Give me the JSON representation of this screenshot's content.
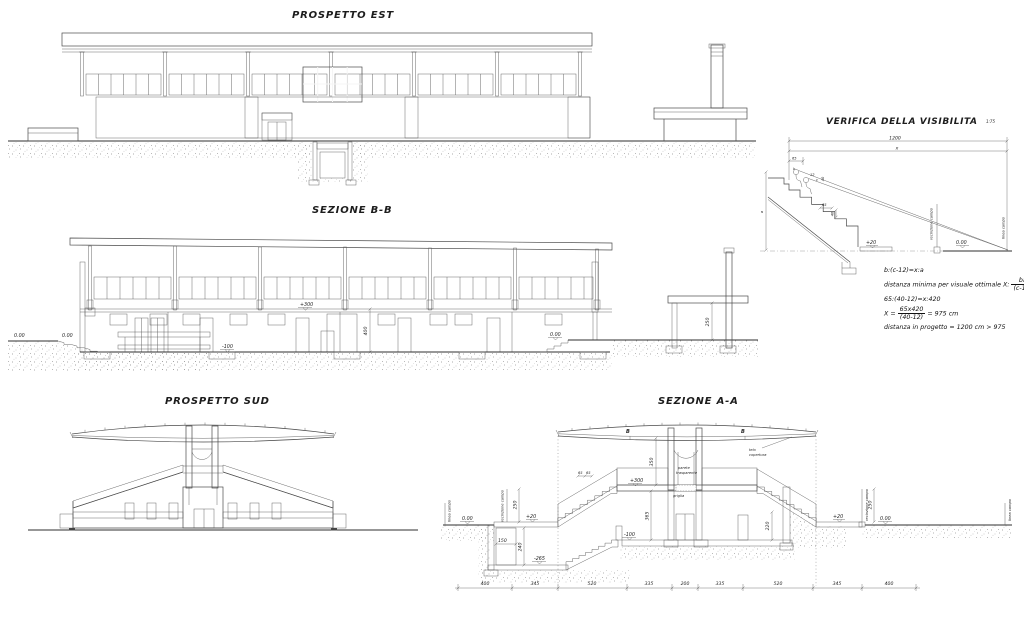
{
  "titles": {
    "prospetto_est": "PROSPETTO EST",
    "sezione_bb": "SEZIONE B-B",
    "prospetto_sud": "PROSPETTO SUD",
    "sezione_aa": "SEZIONE A-A",
    "verifica": "VERIFICA DELLA VISIBILITA",
    "verifica_scale": "1:75"
  },
  "colors": {
    "ink": "#4a4a4a",
    "panel_gray": "#c8c8c8",
    "background": "#ffffff"
  },
  "sezione_bb": {
    "level_field": "0.00",
    "level_ramp": "0.00",
    "level_beam": "+300",
    "dim_height": "400",
    "level_floor": "-100",
    "level_right": "0.00",
    "dim_tribune": "250"
  },
  "sezione_aa": {
    "linea_campo_left": "linea campo",
    "level_zero_left": "0.00",
    "recinzione_left": "recinzione campo",
    "dim_fence_left": "250",
    "level_plus20_left": "+20",
    "dim_shaft": "150",
    "dim_trench": "240",
    "level_minus265": "-265",
    "level_minus100": "-100",
    "dim_interior": "365",
    "dim_canopy": "350",
    "level_plus300": "+300",
    "dim_step_a": "65",
    "dim_step_b": "65",
    "parete_line1": "parete",
    "parete_line2": "trasparente",
    "griglia": "griglia",
    "telo_line1": "telo",
    "telo_line2": "copertura",
    "marker_b_left": "B",
    "marker_b_right": "B",
    "dim_door": "220",
    "level_plus20_right": "+20",
    "dim_fence_right": "250",
    "recinzione_right": "recinzione campo",
    "level_zero_right": "0.00",
    "linea_campo_right": "linea campo",
    "dim_chain": [
      "400",
      "345",
      "520",
      "335",
      "200",
      "335",
      "520",
      "345",
      "400"
    ]
  },
  "verifica": {
    "dim_total": "1200",
    "dim_x": "x",
    "dim_65": "65",
    "var_b": "b",
    "var_a": "a",
    "dim_12": "12",
    "var_c": "c",
    "dim_40_eye": "40",
    "dim_step_w": "65",
    "dim_step_h": "40",
    "level_plus20": "+20",
    "level_zero": "0.00",
    "recinzione": "recinzione campo",
    "linea_campo": "linea campo",
    "formula_1": "b:(c-12)=x:a",
    "formula_2_text": "distanza minima per visuale ottimale X:",
    "formula_2_num": "ba",
    "formula_2_den": "(c-12)",
    "formula_3": "65:(40-12)=x:420",
    "formula_4_pre": "X =",
    "formula_4_num": "65x420",
    "formula_4_den": "(40-12)",
    "formula_4_post": "= 975 cm",
    "formula_5": "distanza in progetto = 1200 cm > 975"
  }
}
